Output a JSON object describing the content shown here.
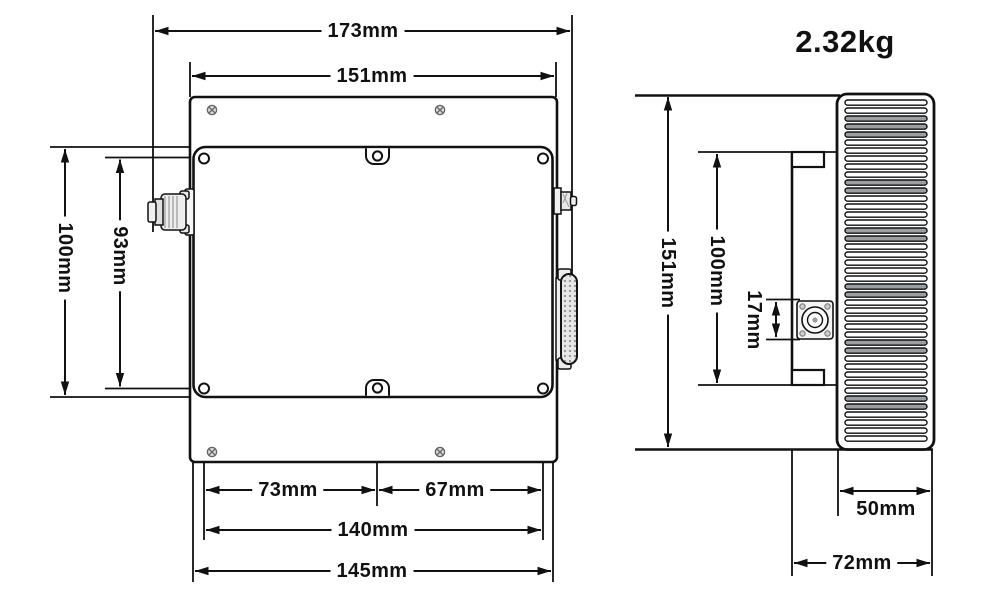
{
  "weight": "2.32kg",
  "top_view": {
    "overall_width": "173mm",
    "flange_width": "151mm",
    "cover_height": "100mm",
    "mount_hole_vertical_pitch": "93mm",
    "hole_offset_left": "73mm",
    "hole_offset_right": "67mm",
    "mount_hole_horizontal_pitch": "140mm",
    "cover_width": "145mm"
  },
  "side_view": {
    "flange_height": "151mm",
    "body_height": "100mm",
    "connector_height": "17mm",
    "heatsink_depth": "50mm",
    "overall_depth": "72mm"
  },
  "icons": {
    "left_connector": "rf-connector-n",
    "top_right_connector": "rf-connector-sma",
    "right_connector": "dsub-connector",
    "side_connector": "rf-connector-front",
    "heatsink": "heatsink-fins"
  },
  "colors": {
    "line": "#111111",
    "background": "#ffffff",
    "fin_shade": "#9aa0a3",
    "screw": "#666666"
  }
}
